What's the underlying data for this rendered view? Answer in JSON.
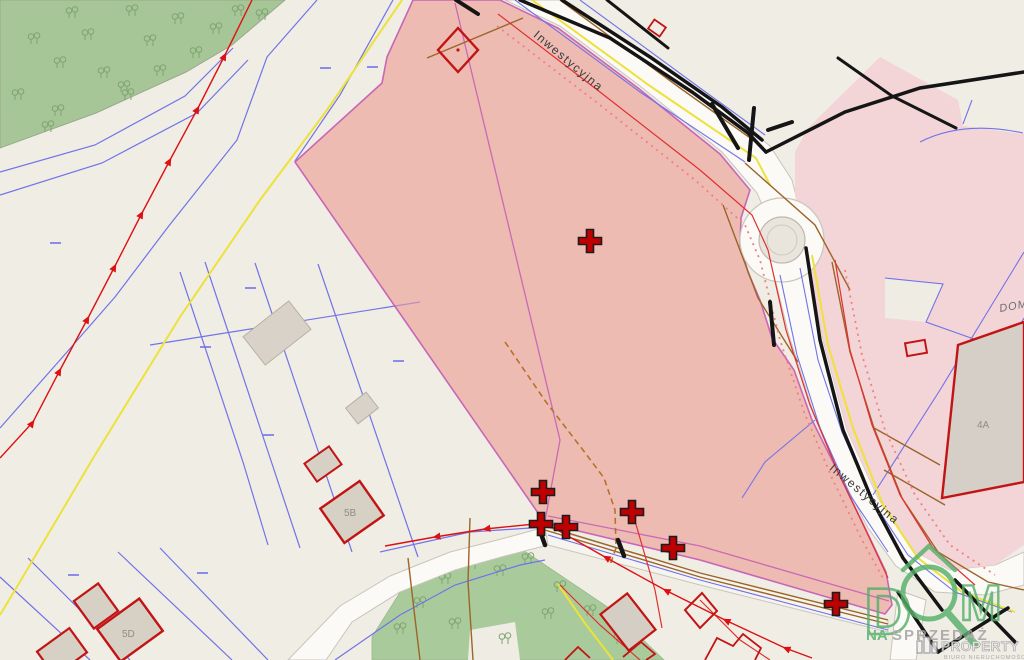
{
  "map": {
    "streets": {
      "top_label": "Inwestycyjna",
      "right_label": "Inwestycyjna"
    },
    "buildings": {
      "b5b": "5B",
      "b5d": "5D",
      "b4a": "4A",
      "dom_partial": "DOM-"
    },
    "markers": {
      "color": "#c00000",
      "positions": [
        [
          590,
          241
        ],
        [
          543,
          492
        ],
        [
          632,
          512
        ],
        [
          541,
          524
        ],
        [
          566,
          527
        ],
        [
          673,
          548
        ],
        [
          836,
          604
        ]
      ]
    },
    "highlight": {
      "main_parcel_fill": "#ee9d94",
      "secondary_area_fill": "#f3d4d7",
      "boundary_color": "#c45ab4"
    },
    "watermark": {
      "dom": "DOM",
      "na": "NA",
      "sprzedaz": "SPRZEDAŻ",
      "property": "PROPERTY",
      "biuro": "BIURO NIERUCHOMOŚCI",
      "logo_green": "#56b06a"
    }
  }
}
